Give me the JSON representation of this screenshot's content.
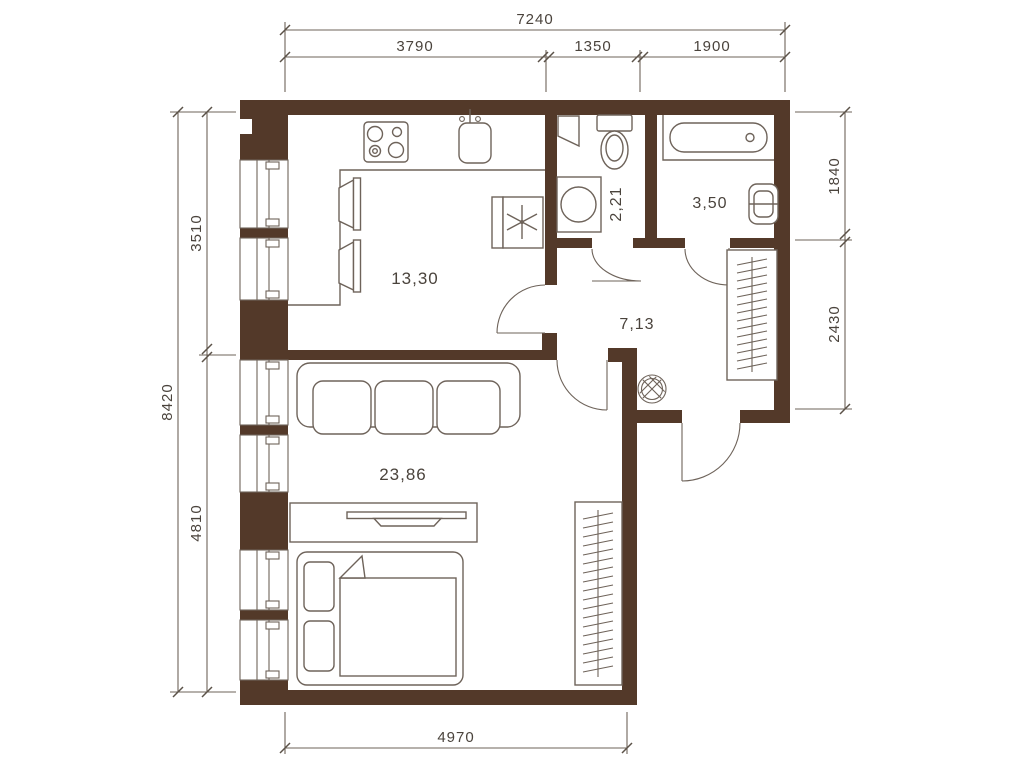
{
  "plan": {
    "rooms": [
      {
        "name": "kitchen",
        "area": "13,30"
      },
      {
        "name": "wc",
        "area": "2,21"
      },
      {
        "name": "bathroom",
        "area": "3,50"
      },
      {
        "name": "hallway",
        "area": "7,13"
      },
      {
        "name": "living-room",
        "area": "23,86"
      }
    ],
    "dims": {
      "top_overall": "7240",
      "top_segments": [
        "3790",
        "1350",
        "1900"
      ],
      "left_overall": "8420",
      "left_segments": [
        "3510",
        "4810"
      ],
      "right_segments": [
        "1840",
        "2430"
      ],
      "bottom_overall": "4970"
    },
    "colors": {
      "wall": "#533929",
      "line": "#6E635A",
      "text": "#4A433C",
      "background": "#FFFFFF"
    }
  }
}
